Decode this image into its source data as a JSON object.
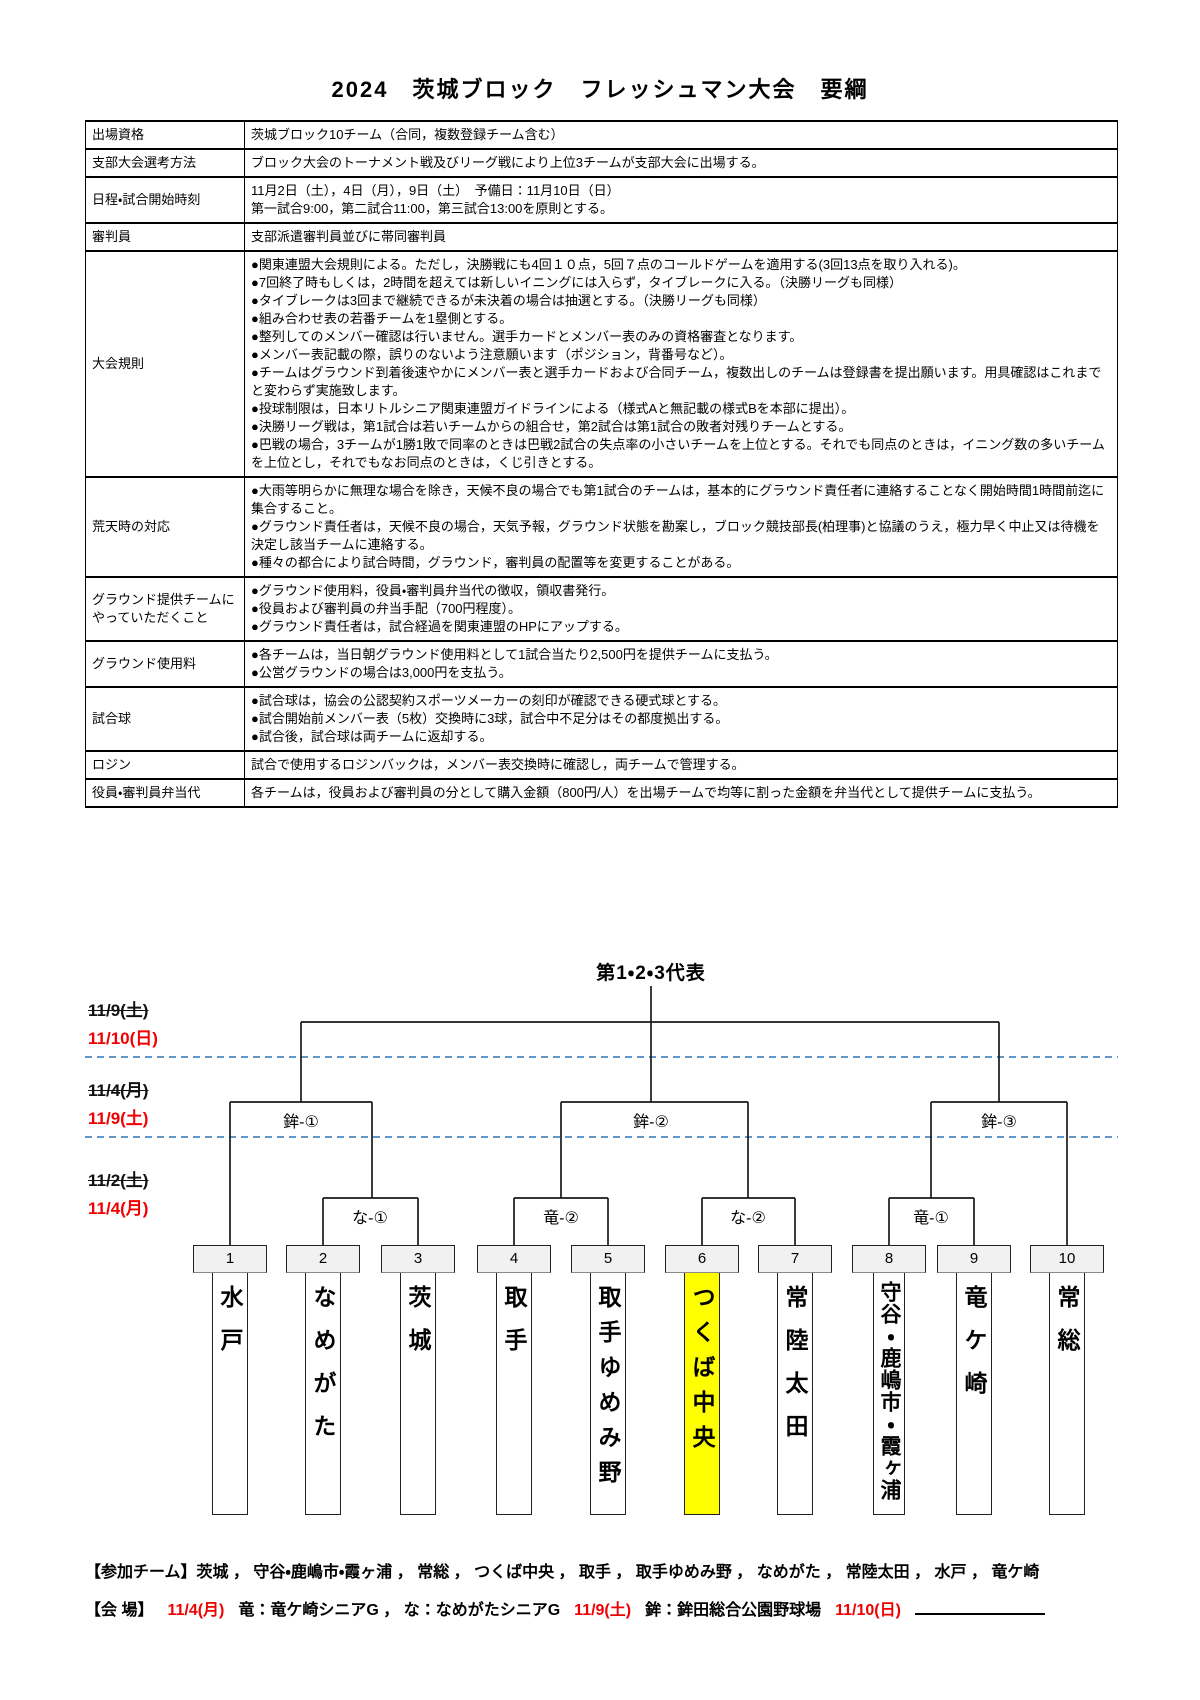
{
  "doc": {
    "title": "2024　茨城ブロック　フレッシュマン大会　要綱"
  },
  "table": {
    "rows": [
      {
        "label": "出場資格",
        "lines": [
          "茨城ブロック10チーム（合同，複数登録チーム含む）"
        ]
      },
      {
        "label": "支部大会選考方法",
        "lines": [
          "ブロック大会のトーナメント戦及びリーグ戦により上位3チームが支部大会に出場する。"
        ]
      },
      {
        "label": "日程・試合開始時刻",
        "lines": [
          "11月2日（土），4日（月），9日（土）　予備日：11月10日（日）",
          "第一試合9:00，第二試合11:00，第三試合13:00を原則とする。"
        ]
      },
      {
        "label": "審判員",
        "lines": [
          "支部派遣審判員並びに帯同審判員"
        ]
      },
      {
        "label": "大会規則",
        "lines": [
          "●関東連盟大会規則による。ただし，決勝戦にも4回１０点，5回７点のコールドゲームを適用する(3回13点を取り入れる)。",
          "●7回終了時もしくは，2時間を超えては新しいイニングには入らず，タイブレークに入る。（決勝リーグも同様）",
          "●タイブレークは3回まで継続できるが未決着の場合は抽選とする。（決勝リーグも同様）",
          "●組み合わせ表の若番チームを1塁側とする。",
          "●整列してのメンバー確認は行いません。選手カードとメンバー表のみの資格審査となります。",
          "●メンバー表記載の際，誤りのないよう注意願います（ポジション，背番号など）。",
          "●チームはグラウンド到着後速やかにメンバー表と選手カードおよび合同チーム，複数出しのチームは登録書を提出願います。用具確認はこれまでと変わらず実施致します。",
          "●投球制限は，日本リトルシニア関東連盟ガイドラインによる（様式Aと無記載の様式Bを本部に提出）。",
          "●決勝リーグ戦は，第1試合は若いチームからの組合せ，第2試合は第1試合の敗者対残りチームとする。",
          "●巴戦の場合，3チームが1勝1敗で同率のときは巴戦2試合の失点率の小さいチームを上位とする。それでも同点のときは，イニング数の多いチームを上位とし，それでもなお同点のときは，くじ引きとする。"
        ]
      },
      {
        "label": "荒天時の対応",
        "lines": [
          "●大雨等明らかに無理な場合を除き，天候不良の場合でも第1試合のチームは，基本的にグラウンド責任者に連絡することなく開始時間1時間前迄に集合すること。",
          "●グラウンド責任者は，天候不良の場合，天気予報，グラウンド状態を勘案し，ブロック競技部長(柏理事)と協議のうえ，極力早く中止又は待機を決定し該当チームに連絡する。",
          "●種々の都合により試合時間，グラウンド，審判員の配置等を変更することがある。"
        ]
      },
      {
        "label": "グラウンド提供チームにやっていただくこと",
        "lines": [
          "●グラウンド使用料，役員・審判員弁当代の徴収，領収書発行。",
          "●役員および審判員の弁当手配（700円程度）。",
          "●グラウンド責任者は，試合経過を関東連盟のHPにアップする。"
        ]
      },
      {
        "label": "グラウンド使用料",
        "lines": [
          "●各チームは，当日朝グラウンド使用料として1試合当たり2,500円を提供チームに支払う。",
          "●公営グラウンドの場合は3,000円を支払う。"
        ]
      },
      {
        "label": "試合球",
        "lines": [
          "●試合球は，協会の公認契約スポーツメーカーの刻印が確認できる硬式球とする。",
          "●試合開始前メンバー表（5枚）交換時に3球，試合中不足分はその都度拠出する。",
          "●試合後，試合球は両チームに返却する。"
        ]
      },
      {
        "label": "ロジン",
        "lines": [
          "試合で使用するロジンバックは，メンバー表交換時に確認し，両チームで管理する。"
        ]
      },
      {
        "label": "役員・審判員弁当代",
        "lines": [
          "各チームは，役員および審判員の分として購入金額（800円/人）を出場チームで均等に割った金額を弁当代として提供チームに支払う。"
        ]
      }
    ]
  },
  "bracket": {
    "final_label": "第1・2・3代表",
    "round_dates": [
      {
        "old": "11/9(土)",
        "new": "11/10(日)"
      },
      {
        "old": "11/4(月)",
        "new": "11/9(土)"
      },
      {
        "old": "11/2(土)",
        "new": "11/4(月)"
      }
    ],
    "round2_matches": [
      "鉾-①",
      "鉾-②",
      "鉾-③"
    ],
    "round1_matches": [
      "な-①",
      "竜-②",
      "な-②",
      "竜-①"
    ],
    "teams": [
      {
        "no": "1",
        "name": "水戸",
        "highlight": false
      },
      {
        "no": "2",
        "name": "なめがた",
        "highlight": false
      },
      {
        "no": "3",
        "name": "茨城",
        "highlight": false
      },
      {
        "no": "4",
        "name": "取手",
        "highlight": false
      },
      {
        "no": "5",
        "name": "取手ゆめみ野",
        "highlight": false
      },
      {
        "no": "6",
        "name": "つくば中央",
        "highlight": true
      },
      {
        "no": "7",
        "name": "常陸太田",
        "highlight": false
      },
      {
        "no": "8",
        "name": "守谷・鹿嶋市・霞ヶ浦",
        "highlight": false
      },
      {
        "no": "9",
        "name": "竜ケ崎",
        "highlight": false
      },
      {
        "no": "10",
        "name": "常総",
        "highlight": false
      }
    ],
    "highlight_color": "#ffff00",
    "line_color": "#1a1a1a",
    "dashed_line_color": "#2e75b6",
    "strike_date_color": "#111111",
    "new_date_color": "#f00000"
  },
  "footer": {
    "participants_label": "【参加チーム】",
    "participants": "茨城 ， 守谷・鹿嶋市・霞ヶ浦 ， 常総 ， つくば中央 ， 取手 ， 取手ゆめみ野 ， なめがた ， 常陸太田 ， 水戸 ， 竜ケ崎",
    "venue_label": "【会 場】",
    "venue_parts": [
      {
        "text": "11/4(月)",
        "red": true,
        "blank": false
      },
      {
        "text": "竜：竜ケ崎シニアG ， な：なめがたシニアG",
        "red": false,
        "blank": false
      },
      {
        "text": "11/9(土)",
        "red": true,
        "blank": false
      },
      {
        "text": "鉾：鉾田総合公園野球場",
        "red": false,
        "blank": false
      },
      {
        "text": "11/10(日)",
        "red": true,
        "blank": false
      },
      {
        "text": "",
        "red": false,
        "blank": true
      }
    ]
  }
}
